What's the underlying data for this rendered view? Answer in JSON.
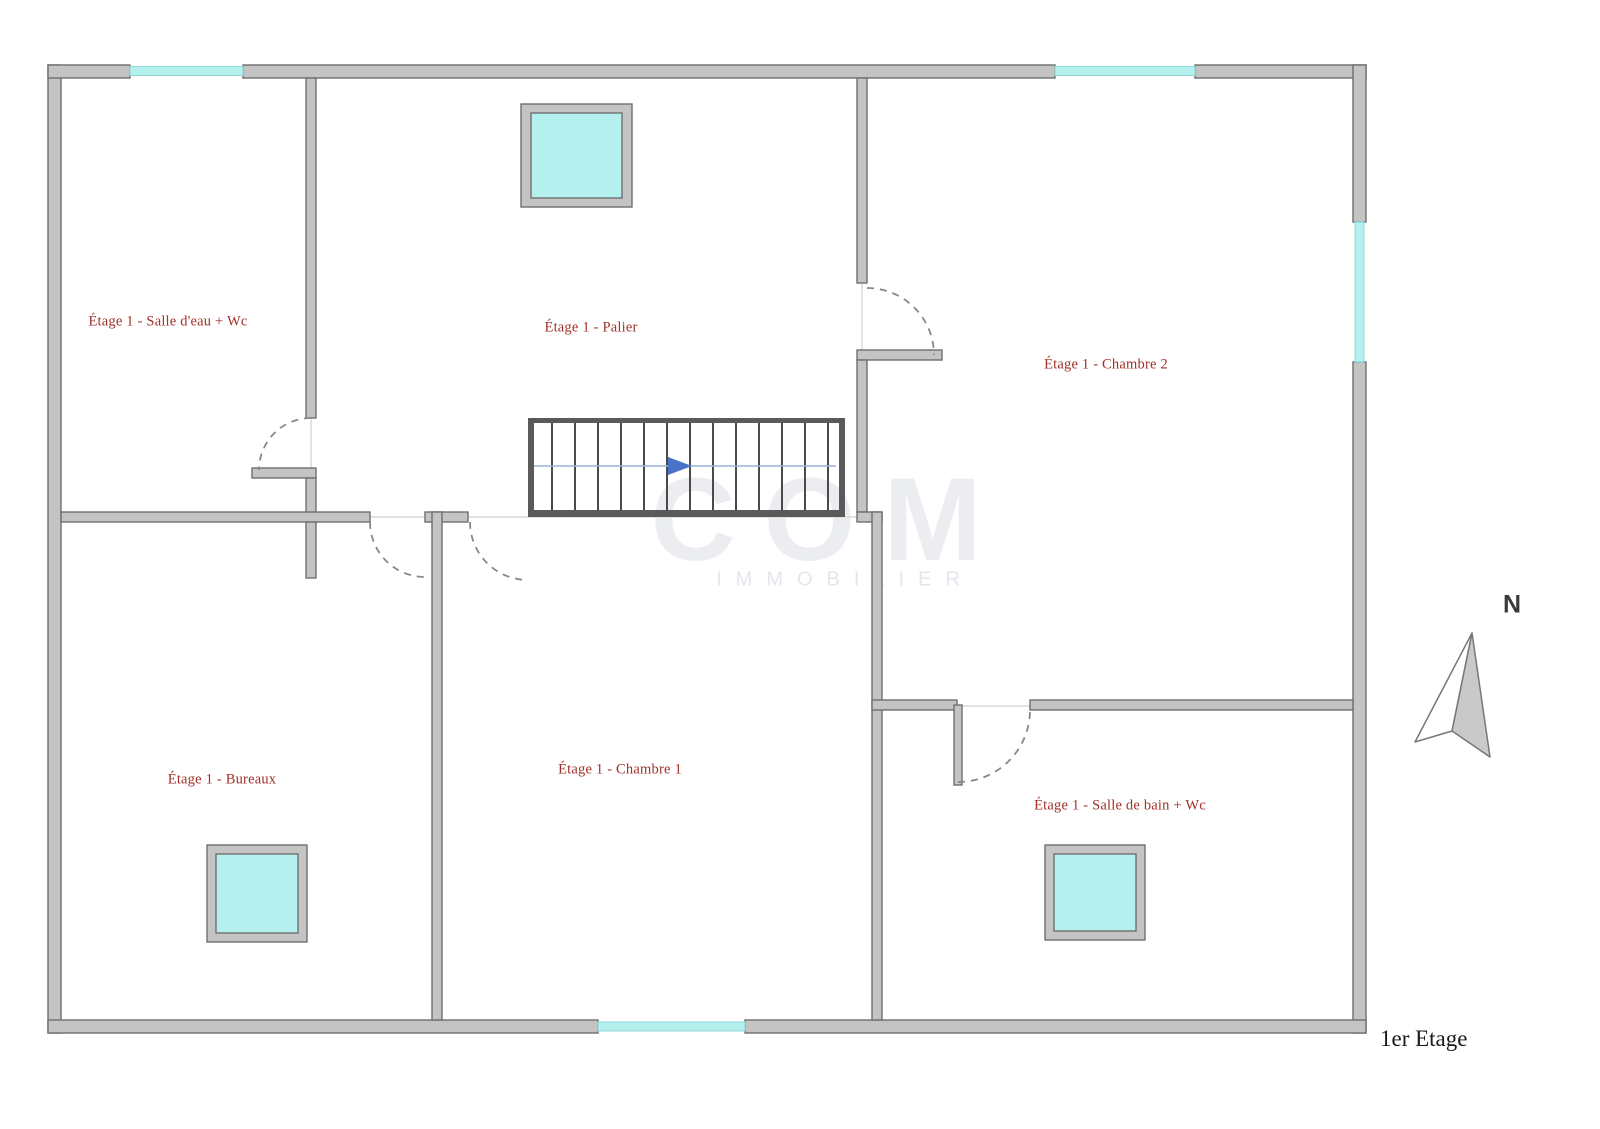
{
  "page": {
    "floor_title": "1er Etage",
    "compass_label": "N"
  },
  "watermark": {
    "line1": "COM",
    "line2": "IMMOBILIER"
  },
  "rooms": [
    {
      "id": "salle-deau-wc",
      "label": "Étage 1 - Salle d'eau + Wc"
    },
    {
      "id": "palier",
      "label": "Étage 1 - Palier"
    },
    {
      "id": "chambre-2",
      "label": "Étage 1 - Chambre 2"
    },
    {
      "id": "bureaux",
      "label": "Étage 1 - Bureaux"
    },
    {
      "id": "chambre-1",
      "label": "Étage 1 - Chambre 1"
    },
    {
      "id": "salle-de-bain-wc",
      "label": "Étage 1 - Salle de bain + Wc"
    }
  ],
  "colors": {
    "wall_fill": "#c4c4c4",
    "wall_stroke": "#6f6f6f",
    "window_fill": "#b4f0ee",
    "room_label": "#a03028",
    "stair_guide": "#9ab4d6",
    "stair_arrow": "#4a72c8",
    "compass_fill": "#c9c9c9"
  }
}
